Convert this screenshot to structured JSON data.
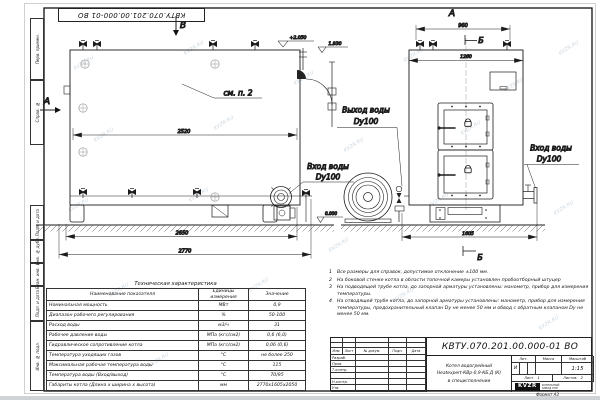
{
  "watermark": {
    "text": "KVZR.RU"
  },
  "frame": {
    "top_ref_number": "КВТУ.070.201.00.000-01 ВО",
    "side_labels": [
      "Перв. примен.",
      "Справ. №",
      "Подп. и дата",
      "Инв. № дубл.",
      "Взам. инв. №",
      "Подп. и дата",
      "Инв. № подл."
    ],
    "format_note": "Формат А3"
  },
  "drawing": {
    "side_view": {
      "section_top": "В",
      "section_left": "А",
      "note_ref": "см. п. 2",
      "dim_shell": "2520",
      "dim_base": "2650",
      "dim_overall": "2770",
      "level_top": "+2.050",
      "level_flue": "1.930",
      "level_ground": "0.000",
      "inlet_line1": "Вход воды",
      "inlet_line2": "Dy100"
    },
    "front_view": {
      "view_label": "А",
      "section_top": "Б",
      "section_bottom": "Б",
      "dim_valves": "960",
      "dim_width": "1260",
      "dim_overall": "1605",
      "outlet_line1": "Выход воды",
      "outlet_line2": "Dy100",
      "inlet_line1": "Вход воды",
      "inlet_line2": "Dy100"
    }
  },
  "notes": {
    "items": [
      {
        "num": "1",
        "text": "Все размеры для справок, допустимое отклонение ±100 мм."
      },
      {
        "num": "2",
        "text": "На боковой стенке котла в области топочной камеры установлен пробоотборный штуцер"
      },
      {
        "num": "3",
        "text": "На подводящей трубе котла, до запорной арматуры установлены: манометр, прибор для измерения температуры."
      },
      {
        "num": "4",
        "text": "На отводящей трубе котла, до запорной арматуры установлены: манометр, прибор для измерения температуры, предохранительный клапан Dу не менее 50 мм и обвод с обратным клапаном Dу не менее 50 мм."
      }
    ]
  },
  "spec_table": {
    "title": "Техническая характеристика",
    "headers": [
      "Наименование показателя",
      "Единицы измерения",
      "Значение"
    ],
    "rows": [
      {
        "name": "Номинальная мощность",
        "unit": "МВт",
        "value": "0,9"
      },
      {
        "name": "Диапазон рабочего регулирования",
        "unit": "%",
        "value": "50-100"
      },
      {
        "name": "Расход воды",
        "unit": "м3/ч",
        "value": "31"
      },
      {
        "name": "Рабочее давление воды",
        "unit": "МПа (кгс/см2)",
        "value": "0,6 (6,0)"
      },
      {
        "name": "Гидравлическое сопротивление котла",
        "unit": "МПа (кгс/см2)",
        "value": "0,06 (0,6)"
      },
      {
        "name": "Температура уходящих газов",
        "unit": "°С",
        "value": "не более 250"
      },
      {
        "name": "Максимальная рабочая температура воды",
        "unit": "°С",
        "value": "115"
      },
      {
        "name": "Температура воды (Вход/выход)",
        "unit": "°С",
        "value": "70/95"
      },
      {
        "name": "Габариты котла (Длина х ширина х высота)",
        "unit": "мм",
        "value": "2770х1605х2050"
      }
    ]
  },
  "title_block": {
    "doc_number": "КВТУ.070.201.00.000-01 ВО",
    "title_line1": "Котел водогрейный",
    "title_line2": "Heatexpert-КВр-0,9-КБ.Д (К)",
    "title_line3": "в специсполнении",
    "header_cells": [
      "Изм.",
      "Лист",
      "№ докум.",
      "Подп.",
      "Дата"
    ],
    "rows": [
      "Разраб.",
      "Пров.",
      "Т.контр.",
      "",
      "Н.контр.",
      "Утв."
    ],
    "lit_header": "Лит.",
    "mass_header": "Масса",
    "scale_header": "Масштаб",
    "lit_value": "И",
    "scale_value": "1:15",
    "sheet_label": "Лист",
    "sheet_value": "1",
    "sheets_label": "Листов",
    "sheets_value": "2",
    "logo_text": "KVZR",
    "logo_sub1": "КОТЕЛЬНЫЙ",
    "logo_sub2": "ЗАВОД РЭП"
  }
}
